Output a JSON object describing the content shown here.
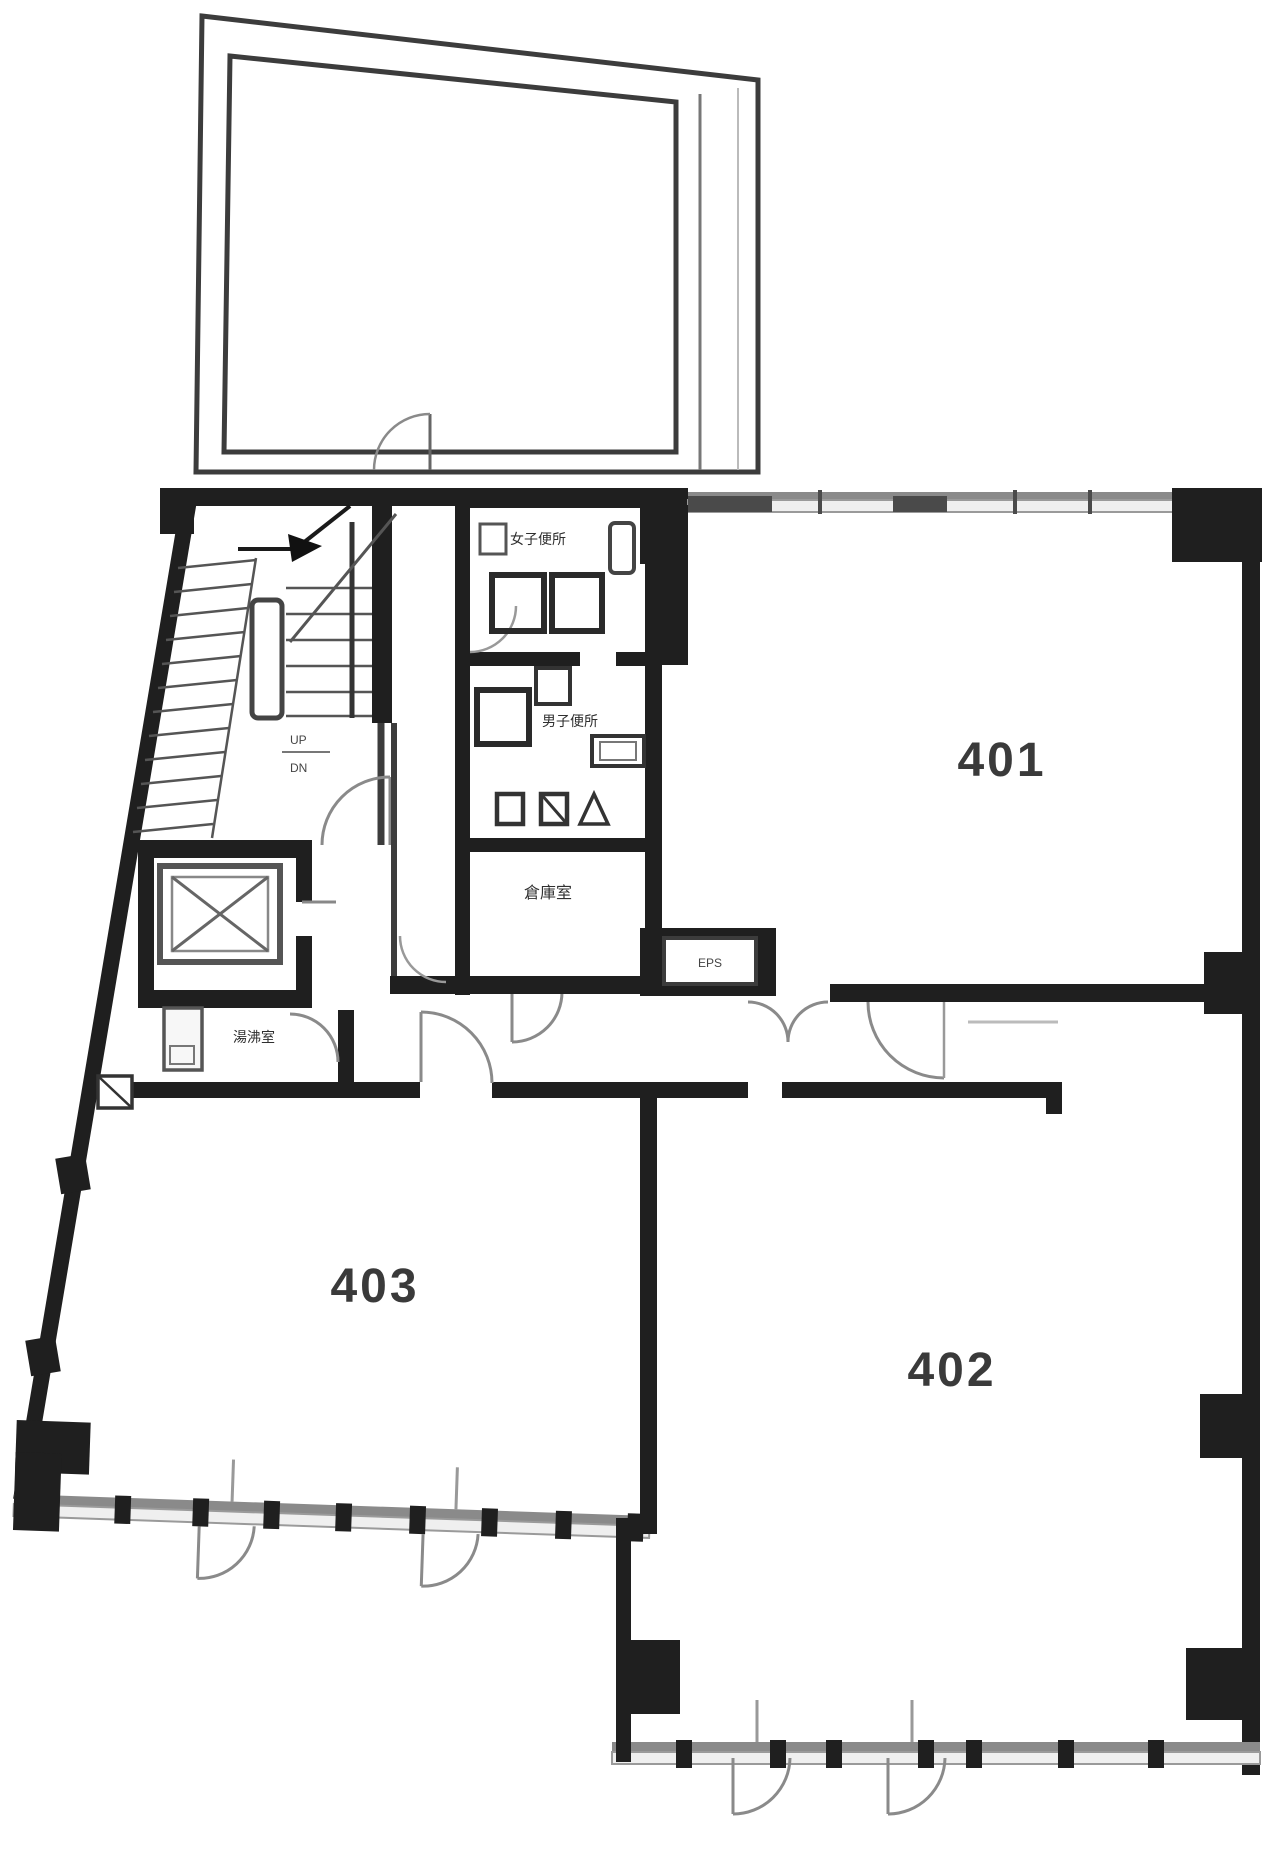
{
  "plan": {
    "rooms": {
      "room401": {
        "label": "401"
      },
      "room402": {
        "label": "402"
      },
      "room403": {
        "label": "403"
      }
    },
    "facilities": {
      "womens_toilet": {
        "label": "女子便所"
      },
      "mens_toilet": {
        "label": "男子便所"
      },
      "storage": {
        "label": "倉庫室"
      },
      "kitchenette": {
        "label": "湯沸室"
      },
      "eps": {
        "label": "EPS"
      },
      "stairs": {
        "up_label": "UP",
        "down_label": "DN"
      }
    },
    "colors": {
      "wall": "#1f1f1f",
      "line": "#3c3c3c",
      "thin": "#8a8a8a",
      "window_fill": "#efefef",
      "window_edge": "#9a9a9a",
      "text": "#3a3a3a",
      "background": "#ffffff"
    }
  }
}
